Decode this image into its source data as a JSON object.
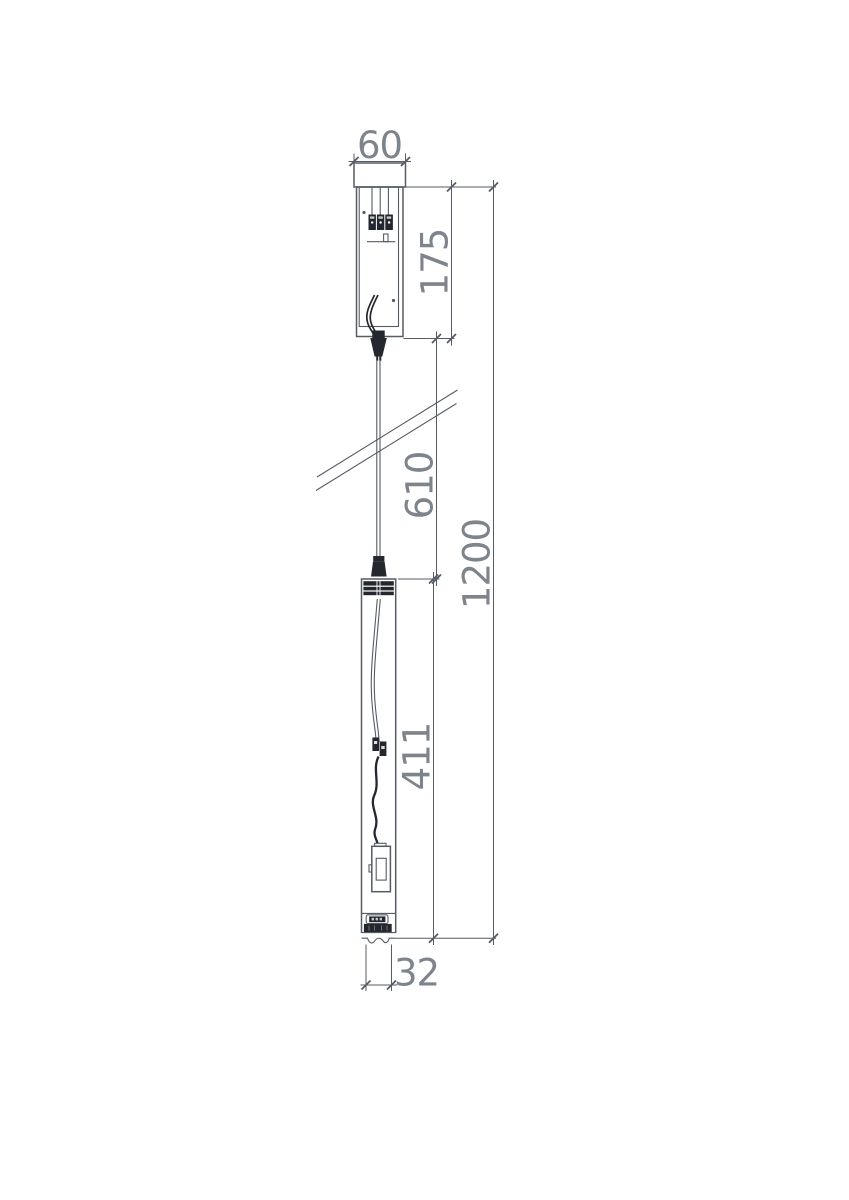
{
  "drawing": {
    "dimensions": {
      "canopy_width": "60",
      "canopy_height": "175",
      "suspension_length": "610",
      "overall_height": "1200",
      "fixture_length": "411",
      "fixture_width": "32"
    },
    "colors": {
      "line": "#565c64",
      "dark_fill": "#24272d",
      "dim_text": "#7e848c",
      "background": "#ffffff"
    }
  }
}
